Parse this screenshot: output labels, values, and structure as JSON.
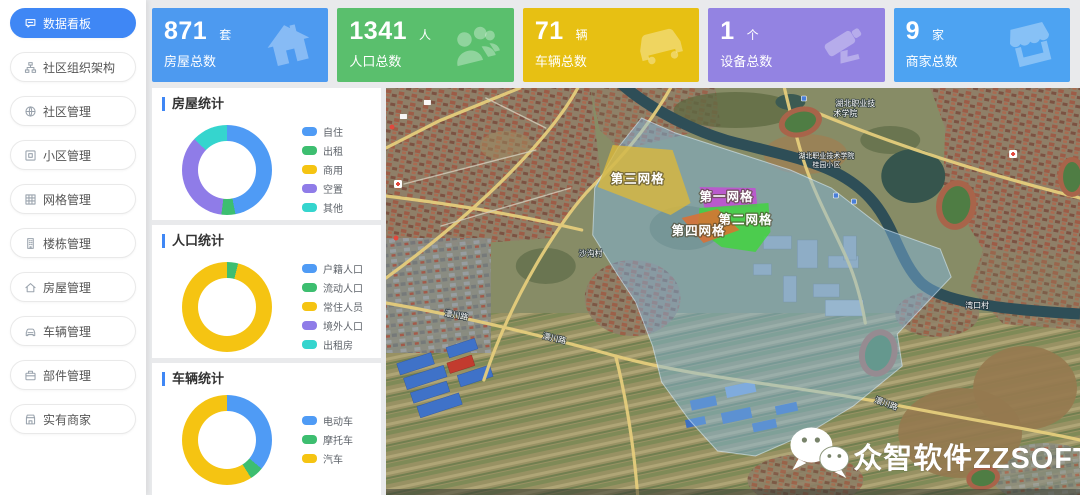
{
  "theme": {
    "accent": "#3f87f5",
    "background": "#e9eaec"
  },
  "sidebar": {
    "items": [
      {
        "key": "dashboard",
        "label": "数据看板",
        "icon": "dashboard-icon",
        "active": true
      },
      {
        "key": "org",
        "label": "社区组织架构",
        "icon": "org-structure-icon",
        "active": false
      },
      {
        "key": "community",
        "label": "社区管理",
        "icon": "community-icon",
        "active": false
      },
      {
        "key": "estate",
        "label": "小区管理",
        "icon": "estate-icon",
        "active": false
      },
      {
        "key": "grid",
        "label": "网格管理",
        "icon": "grid-icon",
        "active": false
      },
      {
        "key": "building",
        "label": "楼栋管理",
        "icon": "building-icon",
        "active": false
      },
      {
        "key": "house",
        "label": "房屋管理",
        "icon": "house-icon",
        "active": false
      },
      {
        "key": "vehicle",
        "label": "车辆管理",
        "icon": "vehicle-icon",
        "active": false
      },
      {
        "key": "component",
        "label": "部件管理",
        "icon": "component-icon",
        "active": false
      },
      {
        "key": "merchant",
        "label": "实有商家",
        "icon": "merchant-icon",
        "active": false
      }
    ]
  },
  "stats": [
    {
      "value": "871",
      "unit": "套",
      "label": "房屋总数",
      "color": "#4d9af0"
    },
    {
      "value": "1341",
      "unit": "人",
      "label": "人口总数",
      "color": "#5abf6d"
    },
    {
      "value": "71",
      "unit": "辆",
      "label": "车辆总数",
      "color": "#e7c013"
    },
    {
      "value": "1",
      "unit": "个",
      "label": "设备总数",
      "color": "#9383e2"
    },
    {
      "value": "9",
      "unit": "家",
      "label": "商家总数",
      "color": "#4da3f2"
    }
  ],
  "chart_data": [
    {
      "type": "pie",
      "donut": true,
      "title": "房屋统计",
      "legend_position": "right",
      "labels": [
        "自住",
        "出租",
        "商用",
        "空置",
        "其他"
      ],
      "values": [
        47,
        5,
        0,
        35,
        13
      ],
      "colors": [
        "#4f9bf5",
        "#3dbe70",
        "#f5c412",
        "#8f7ce8",
        "#35d5ce"
      ]
    },
    {
      "type": "pie",
      "donut": true,
      "title": "人口统计",
      "legend_position": "right",
      "labels": [
        "户籍人口",
        "流动人口",
        "常住人员",
        "境外人口",
        "出租房"
      ],
      "values": [
        0,
        4,
        96,
        0,
        0
      ],
      "colors": [
        "#4f9bf5",
        "#3dbe70",
        "#f5c412",
        "#8f7ce8",
        "#35d5ce"
      ]
    },
    {
      "type": "pie",
      "donut": true,
      "title": "车辆统计",
      "legend_position": "right",
      "labels": [
        "电动车",
        "摩托车",
        "汽车"
      ],
      "values": [
        36,
        5,
        59
      ],
      "colors": [
        "#4f9bf5",
        "#3dbe70",
        "#f5c412"
      ]
    }
  ],
  "map": {
    "grids": [
      {
        "name": "第三网格",
        "color": "#ddb83a"
      },
      {
        "name": "第一网格",
        "color": "#c44ad6"
      },
      {
        "name": "第二网格",
        "color": "#3fd63c"
      },
      {
        "name": "第四网格",
        "color": "#de7030"
      }
    ],
    "labels": {
      "college_line1": "湖北职业技",
      "college_line2": "术学院",
      "college2": "湖北职业技术学院",
      "college2_sub": "桂园小区",
      "village_shagou": "沙沟村",
      "village_wankou": "湾口村",
      "road": "澴川路"
    },
    "watermark": "众智软件ZZSOFT"
  }
}
